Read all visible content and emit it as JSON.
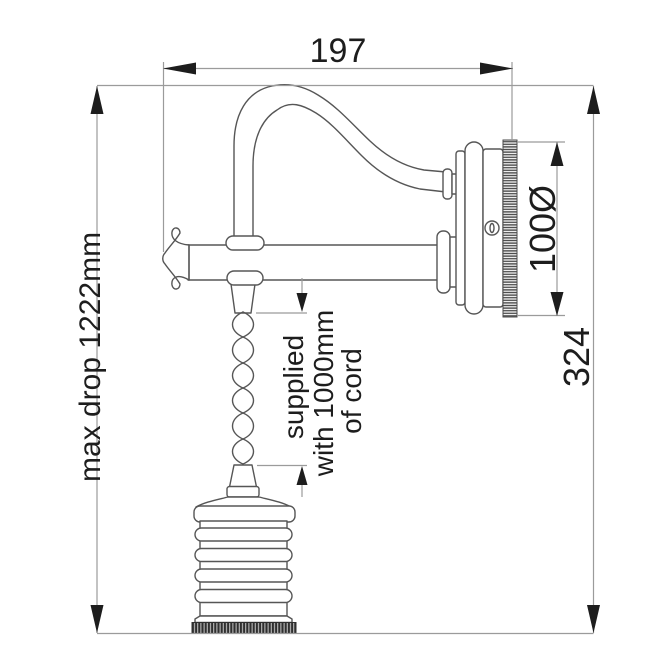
{
  "drawing": {
    "labels": {
      "width": "197",
      "max_drop": "max drop 1222mm",
      "height": "324",
      "diameter": "100Ø",
      "cord_line1": "supplied",
      "cord_line2": "with 1000mm",
      "cord_line3": "of cord"
    },
    "colors": {
      "background": "#ffffff",
      "outline": "#565656",
      "dimension_line": "#9b9b9b",
      "text": "#1d1d1d",
      "arrow": "#1d1d1d"
    }
  }
}
